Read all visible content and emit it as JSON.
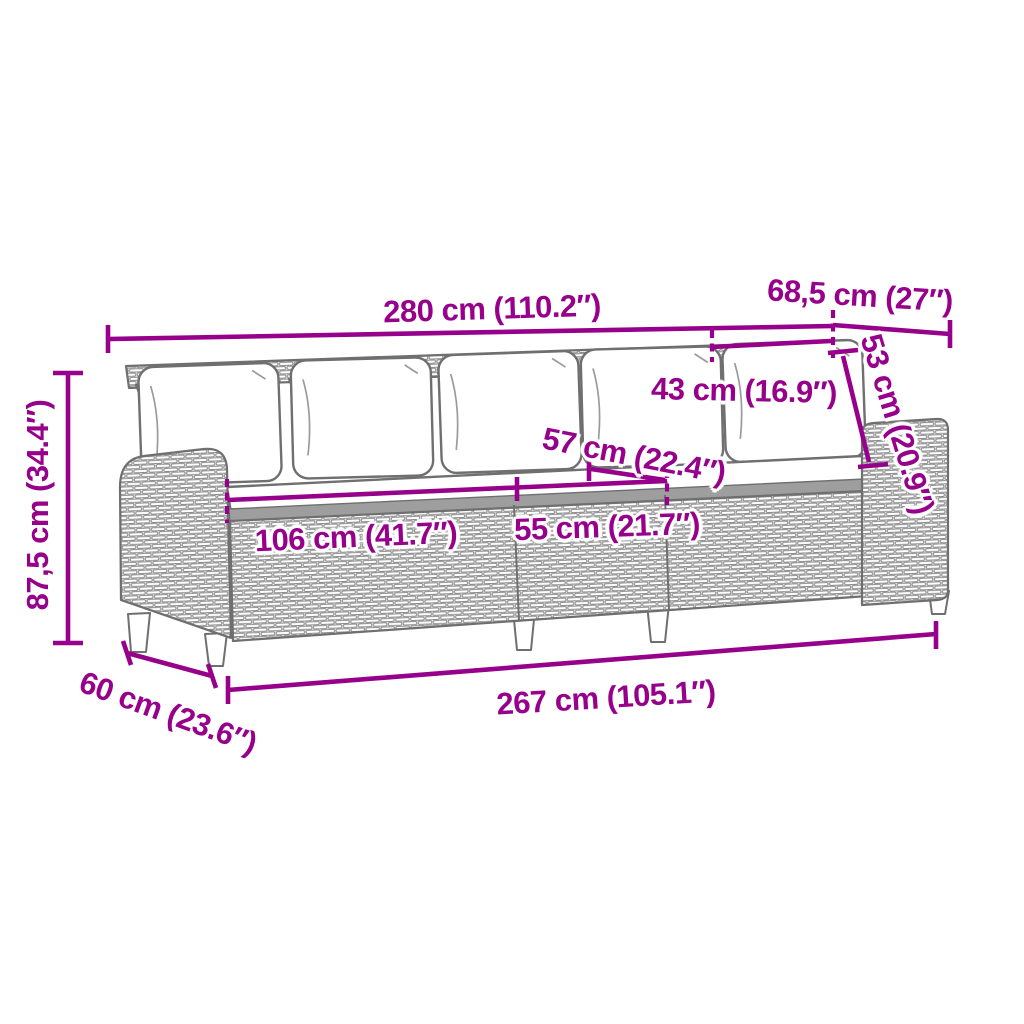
{
  "canvas": {
    "width": 1024,
    "height": 1024,
    "background": "#ffffff"
  },
  "colors": {
    "dimension": "#97008a",
    "artwork_outline": "#6f6f6f",
    "weave_line": "#8c8c8c",
    "weave_fill": "#ececec",
    "rim_fill": "#9e9e9e",
    "cushion_fill": "#ffffff"
  },
  "diagram": {
    "artwork": "grey line-art perspective drawing of a three-section poly rattan garden sofa with five back cushions, a long seat cushion and small tapered feet",
    "dimensions": {
      "back_width": {
        "label": "280 cm (110.2″)"
      },
      "end_depth_top": {
        "label": "68,5 cm (27″)"
      },
      "back_corner_height": {
        "label": "53 cm (20.9″)"
      },
      "back_cushion_width": {
        "label": "43 cm (16.9″)"
      },
      "seat_depth": {
        "label": "57 cm (22.4″)"
      },
      "seat_width_single": {
        "label": "55 cm (21.7″)"
      },
      "seat_width_double": {
        "label": "106 cm (41.7″)"
      },
      "total_height": {
        "label": "87,5 cm (34.4″)"
      },
      "end_depth_bottom": {
        "label": "60 cm (23.6″)"
      },
      "base_width": {
        "label": "267 cm (105.1″)"
      }
    }
  }
}
